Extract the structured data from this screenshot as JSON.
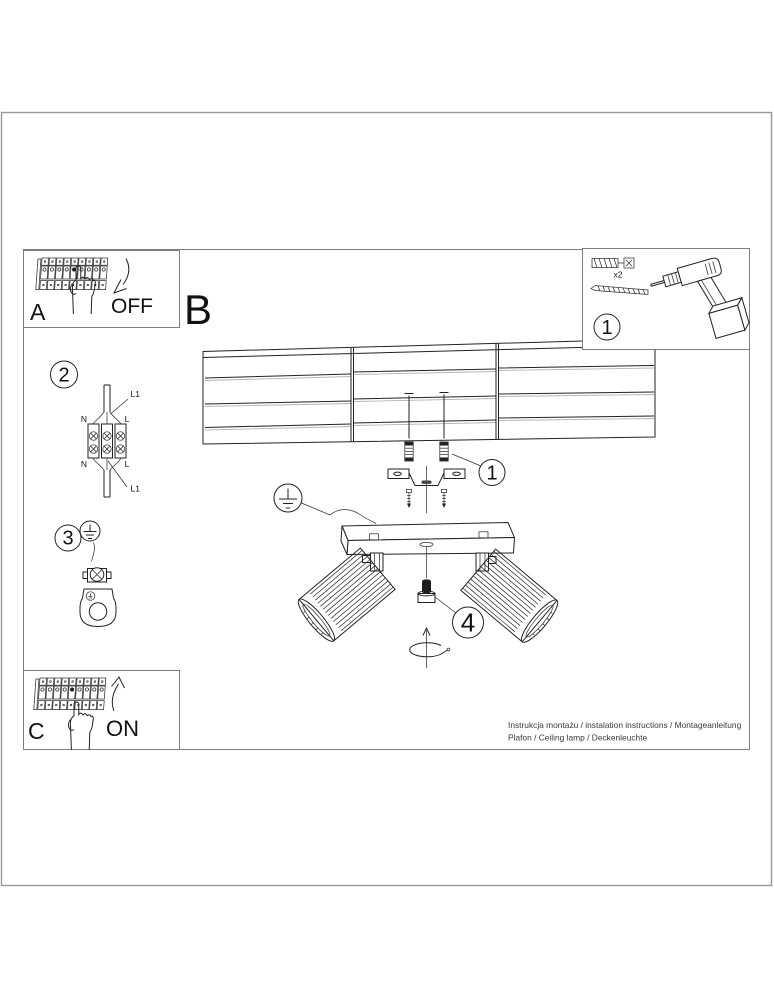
{
  "colors": {
    "line": "#222222",
    "frame": "#7d7d7d",
    "background": "#ffffff"
  },
  "sections": {
    "a": {
      "label": "A",
      "state": "OFF"
    },
    "b": {
      "label": "B"
    },
    "c": {
      "label": "C",
      "state": "ON"
    }
  },
  "steps": {
    "tools": "1",
    "mount": "1",
    "wiring": "2",
    "earth": "3",
    "adjust": "4"
  },
  "tools": {
    "anchor_qty": "x2"
  },
  "wiring": {
    "l1_top": "L1",
    "l1_bottom": "L1",
    "n_top": "N",
    "n_bottom": "N",
    "l_top": "L",
    "l_bottom": "L"
  },
  "footer": {
    "line1": "Instrukcja montażu / instalation instructions / Montageanleitung",
    "line2": "Plafon / Ceiling lamp / Deckenleuchte"
  }
}
